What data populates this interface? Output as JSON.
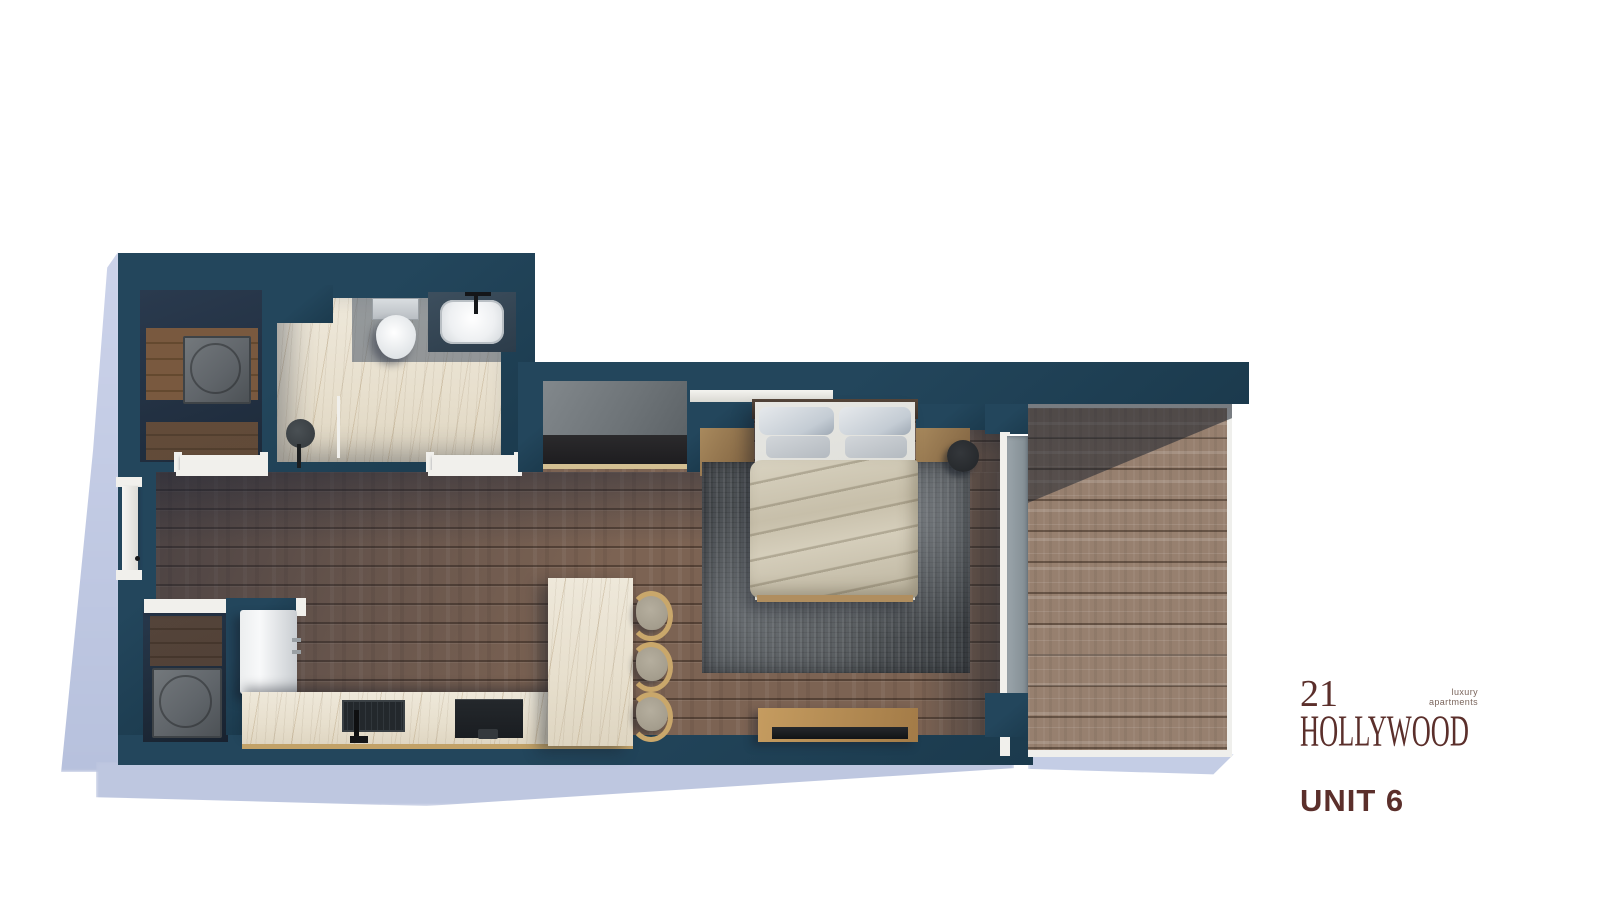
{
  "logo": {
    "number": "21",
    "name": "HOLLYWOOD",
    "tagline_line1": "luxury",
    "tagline_line2": "apartments",
    "unit": "UNIT 6"
  },
  "palette": {
    "wall": "#23465c",
    "wall-deep": "#1b3a4d",
    "floor": "#7c6353",
    "deck": "#97806f",
    "marble": "#e7dfcd",
    "rug": "#53575a",
    "duvet": "#cdc6b3",
    "wood": "#c9a76b",
    "cushion": "#a49d8d",
    "white-trim": "#f1f0ec",
    "shadow": "#bec7e0",
    "logo": "#5b2f2b"
  },
  "floorplan": {
    "rooms": [
      "laundry-closet",
      "bathroom",
      "entry",
      "kitchen",
      "living-bedroom",
      "storage-closet",
      "balcony-deck"
    ],
    "fixtures": [
      "washer-dryer-unit",
      "toilet",
      "vanity-sink",
      "shower",
      "entry-door",
      "water-heater-unit",
      "refrigerator",
      "kitchen-sink",
      "cooktop",
      "kitchen-island",
      "bar-stools",
      "wardrobe",
      "queen-bed",
      "nightstands",
      "table-lamp",
      "area-rug",
      "tv-console",
      "television",
      "sliding-glass-door"
    ]
  }
}
